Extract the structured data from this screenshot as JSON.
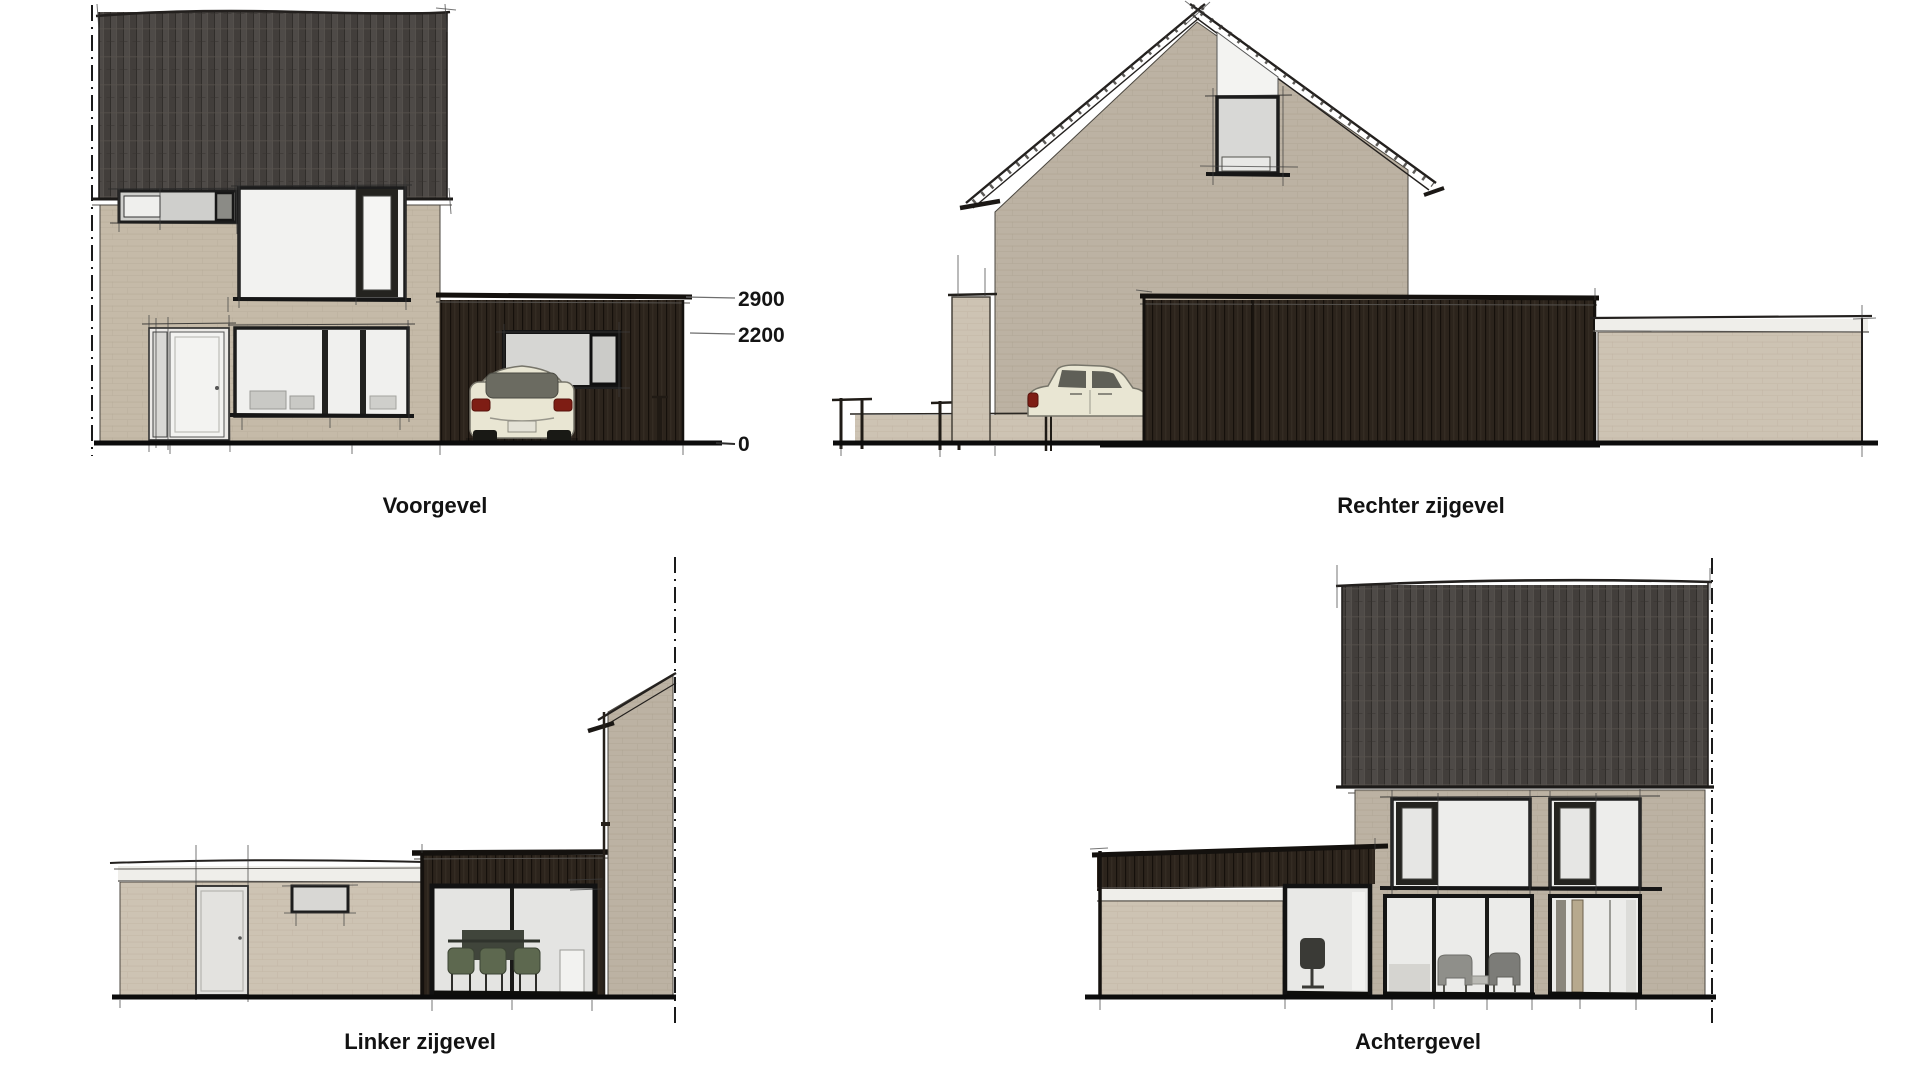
{
  "drawing": {
    "type": "architectural-elevation-sheet",
    "elevations": {
      "front": {
        "label": "Voorgevel"
      },
      "right": {
        "label": "Rechter zijgevel"
      },
      "left": {
        "label": "Linker zijgevel"
      },
      "rear": {
        "label": "Achtergevel"
      }
    },
    "dimensions": {
      "garage_roof": "2900",
      "extension_roof": "2200",
      "ground": "0"
    },
    "palette": {
      "background": "#ffffff",
      "roof_tiles": "#47433f",
      "brick_light": "#cdc3b3",
      "brick_mid": "#c5baa8",
      "brick_gray": "#bcb2a3",
      "cladding_dark_brown": "#2c241c",
      "window_frame": "#1c1c1c",
      "glass_white": "#f2f2f0",
      "glass_gray": "#d6d6d3",
      "fascia_white": "#efeeea",
      "ground_line": "#0c0c0c",
      "car_cream": "#e9e6d3",
      "taillight_red": "#7e1d14",
      "chair_green": "#5d684f",
      "text": "#121212"
    }
  }
}
